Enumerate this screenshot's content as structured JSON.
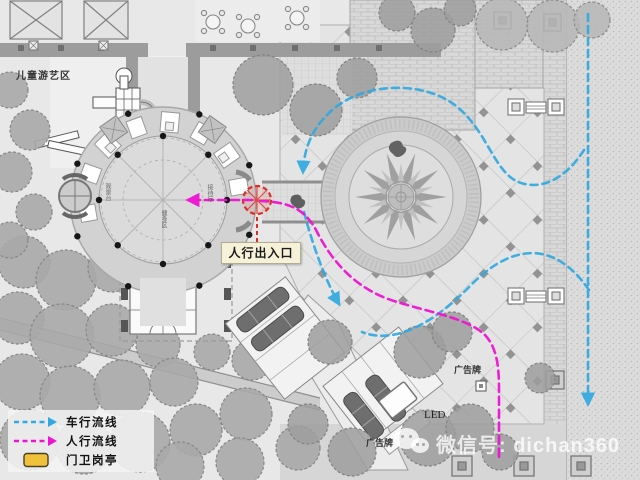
{
  "plan": {
    "labels": {
      "children_play_area": "儿童游艺区",
      "pedestrian_entrance": "人行出入口",
      "billboard_top": "广告牌",
      "billboard_bottom": "广告牌",
      "led_screen": "LED",
      "micro_left": "观景台",
      "micro_right": "接待厅",
      "micro_bottom": "健身区"
    },
    "legend": {
      "items": [
        {
          "id": "vehicle-flow",
          "label": "车行流线",
          "color": "#31a9e0",
          "swatch": "dashed-arrow"
        },
        {
          "id": "pedestrian-flow",
          "label": "人行流线",
          "color": "#ee14d2",
          "swatch": "dashed-arrow"
        },
        {
          "id": "guard-booth",
          "label": "门卫岗亭",
          "color": "#f0c23c",
          "swatch": "rounded-box"
        }
      ]
    },
    "watermark": {
      "icon": "wechat-icon",
      "text": "微信号: dichan360"
    },
    "colors": {
      "vehicle_flow": "#31a9e0",
      "pedestrian_flow": "#ee14d2",
      "guard_booth_fill": "#f0c23c",
      "entrance_marker": "#d93025"
    }
  }
}
